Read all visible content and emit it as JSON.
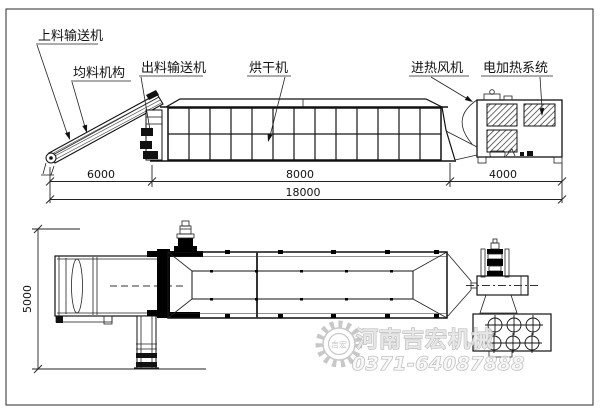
{
  "page": {
    "background": "#ffffff",
    "line_color": "#111111",
    "watermark_color": "#aeaeae"
  },
  "top_view": {
    "labels": [
      {
        "id": "feed-conveyor",
        "text": "上料输送机"
      },
      {
        "id": "leveling-mechanism",
        "text": "均料机构"
      },
      {
        "id": "discharge-conveyor",
        "text": "出料输送机"
      },
      {
        "id": "dryer",
        "text": "烘干机"
      },
      {
        "id": "hot-air-blower",
        "text": "进热风机"
      },
      {
        "id": "electric-heating",
        "text": "电加热系统"
      }
    ],
    "dimensions": {
      "segment1": "6000",
      "segment2": "8000",
      "segment3": "4000",
      "total": "18000"
    }
  },
  "plan_view": {
    "dimensions": {
      "width": "5000"
    }
  },
  "watermark": {
    "company": "河南吉宏机械",
    "phone": "0371-64087888",
    "logo": "吉宏"
  }
}
